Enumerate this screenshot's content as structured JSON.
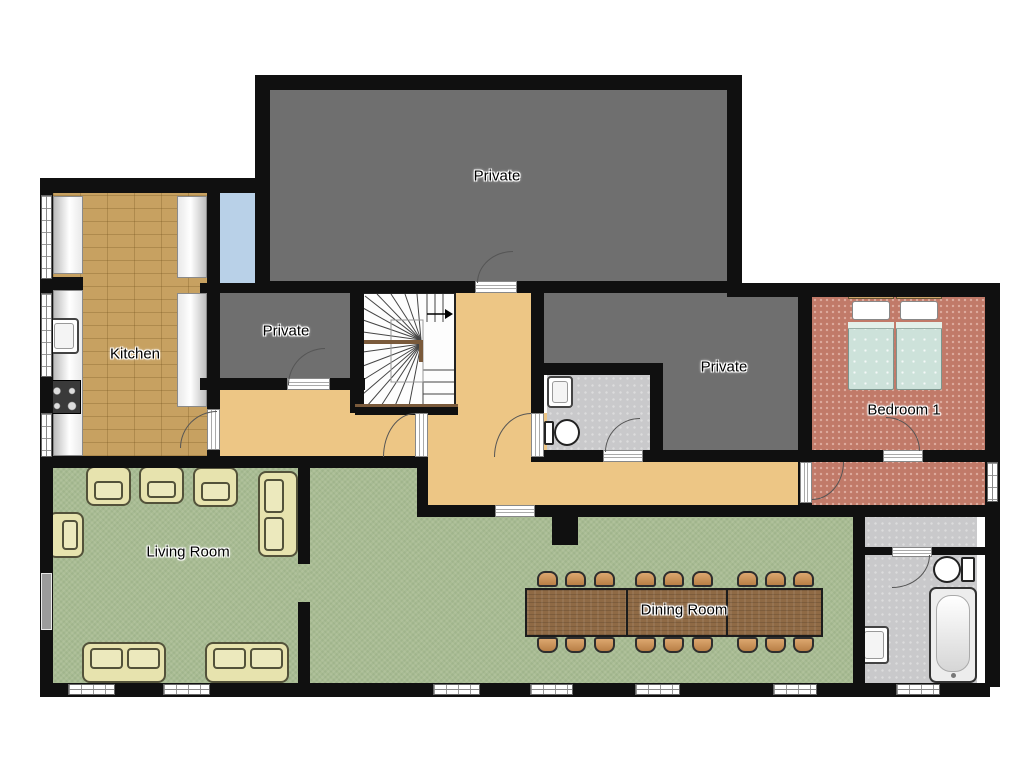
{
  "floorplan": {
    "rooms": [
      {
        "id": "private-top",
        "label": "Private"
      },
      {
        "id": "private-left",
        "label": "Private"
      },
      {
        "id": "private-right",
        "label": "Private"
      },
      {
        "id": "kitchen",
        "label": "Kitchen"
      },
      {
        "id": "bedroom-1",
        "label": "Bedroom 1"
      },
      {
        "id": "living-room",
        "label": "Living Room"
      },
      {
        "id": "dining-room",
        "label": "Dining Room"
      }
    ],
    "colors": {
      "wall": "#101010",
      "private_floor": "#6f6f6f",
      "kitchen_floor": "#c7a161",
      "corridor_floor": "#edc685",
      "living_floor": "#a9bc93",
      "bedroom_floor": "#c17a69",
      "bathroom_floor": "#c9c9cb",
      "closet_floor": "#b9d1e8",
      "table_wood": "#8f6a45",
      "chair_wood": "#d2975f",
      "sofa_fabric": "#e7e3ae",
      "bed_blanket": "#cde2da"
    },
    "icons": [
      "staircase-icon",
      "bed-icon",
      "sofa-icon",
      "armchair-icon",
      "dining-table-icon",
      "chair-icon",
      "toilet-icon",
      "sink-icon",
      "bathtub-icon",
      "stove-icon",
      "counter",
      "window",
      "door-swing-arc",
      "door-opening"
    ]
  }
}
